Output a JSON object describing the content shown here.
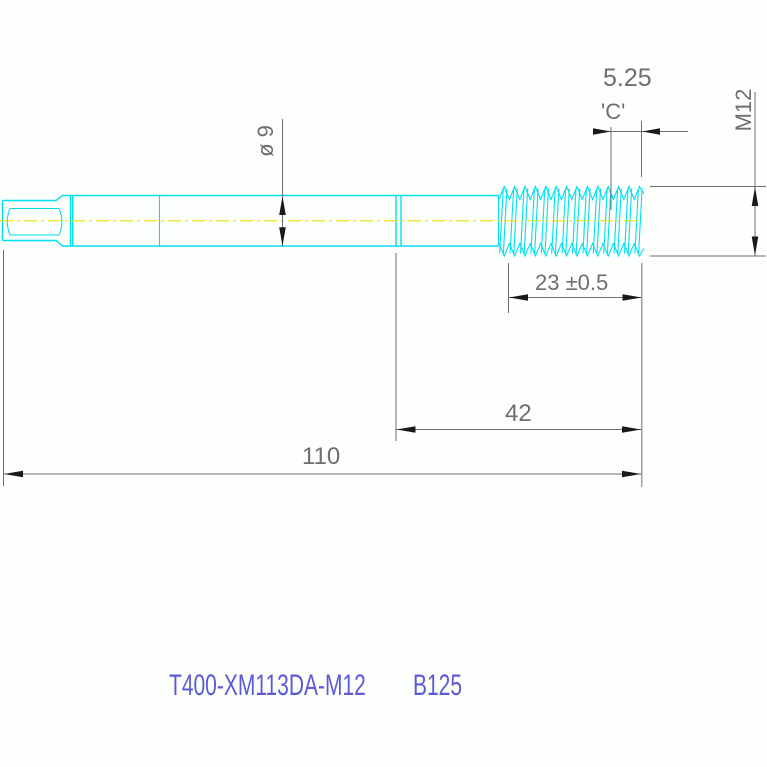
{
  "drawing": {
    "dimensions": {
      "chamfer_length": "5.25",
      "chamfer_label": "'C'",
      "thread_spec": "M12",
      "shank_diameter": "ø 9",
      "thread_length": "23 ±0.5",
      "front_length": "42",
      "overall_length": "110"
    },
    "footer": {
      "part_number": "T400-XM113DA-M12",
      "batch_code": "B125"
    },
    "colors": {
      "part-line": "#00dff0",
      "centerline": "#efe000",
      "dimension": "#6e6e6e",
      "arrow": "#1a1a1a",
      "footer-text": "#5b5bd7"
    }
  }
}
